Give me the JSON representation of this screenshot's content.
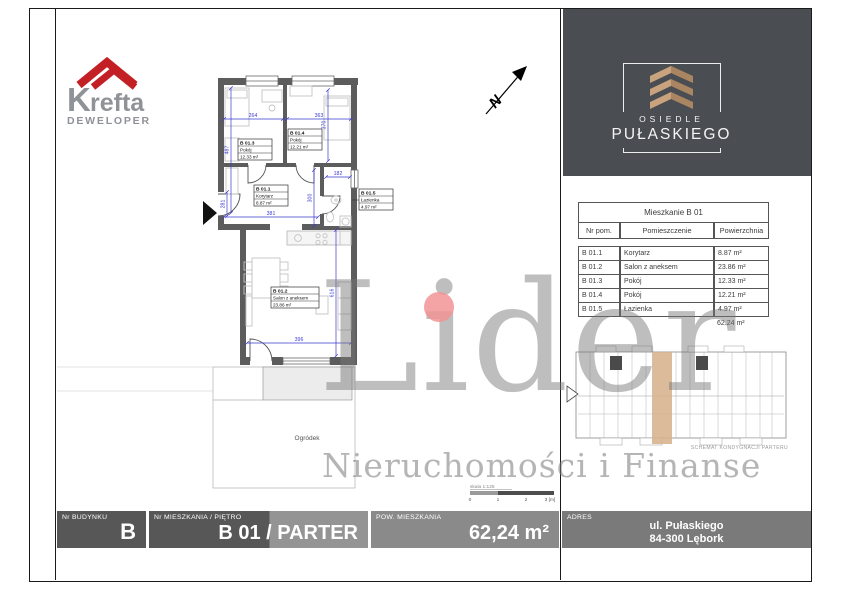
{
  "logo": {
    "brand_initial": "K",
    "brand_rest": "refta",
    "subtitle": "DEWELOPER"
  },
  "badge": {
    "line1": "OSIEDLE",
    "line2": "PUŁASKIEGO"
  },
  "north": {
    "letter": "N"
  },
  "plan": {
    "rooms": [
      {
        "id": "B 01.3",
        "name": "Pokój",
        "area": "12.33 m²"
      },
      {
        "id": "B 01.4",
        "name": "Pokój",
        "area": "12.21 m²"
      },
      {
        "id": "B 01.1",
        "name": "Korytarz",
        "area": "8.87 m²"
      },
      {
        "id": "B 01.5",
        "name": "Łazienka",
        "area": "4.97 m²"
      },
      {
        "id": "B 01.2",
        "name": "Salon z aneksem",
        "area": "23.86 m²"
      }
    ],
    "dimensions": [
      "264",
      "363",
      "487",
      "370",
      "182",
      "300",
      "281",
      "381",
      "616",
      "396"
    ],
    "garden_label": "Ogródek",
    "scale_label": "skala 1:125",
    "scale_ticks": [
      "0",
      "1",
      "2",
      "3 [m]"
    ]
  },
  "table": {
    "title": "Mieszkanie B 01",
    "columns": [
      "Nr pom.",
      "Pomieszczenie",
      "Powierzchnia"
    ],
    "rows": [
      {
        "nr": "B 01.1",
        "name": "Korytarz",
        "area": "8.87 m²"
      },
      {
        "nr": "B 01.2",
        "name": "Salon z aneksem",
        "area": "23.86 m²"
      },
      {
        "nr": "B 01.3",
        "name": "Pokój",
        "area": "12.33 m²"
      },
      {
        "nr": "B 01.4",
        "name": "Pokój",
        "area": "12.21 m²"
      },
      {
        "nr": "B 01.5",
        "name": "Łazienka",
        "area": "4.97 m²"
      }
    ],
    "total": "62.24 m²"
  },
  "schematic": {
    "caption": "SCHEMAT KONDYGNACJI PARTERU"
  },
  "watermark": {
    "title": "Lider",
    "subtitle": "Nieruchomości i Finanse"
  },
  "footer": {
    "building_label": "Nr BUDYNKU",
    "building_value": "B",
    "unit_label": "Nr MIESZKANIA / PIĘTRO",
    "unit_value": "B 01 / PARTER",
    "area_label": "POW. MIESZKANIA",
    "area_value": "62,24 m²",
    "address_label": "ADRES",
    "address_line1": "ul. Pułaskiego",
    "address_line2": "84-300 Lębork"
  },
  "colors": {
    "accent_red": "#c32026",
    "badge_bg": "#4a4d52",
    "badge_gold": "#c8a37d",
    "highlight_tan": "#d7b28c",
    "dimension_blue": "#3b3bd1"
  }
}
